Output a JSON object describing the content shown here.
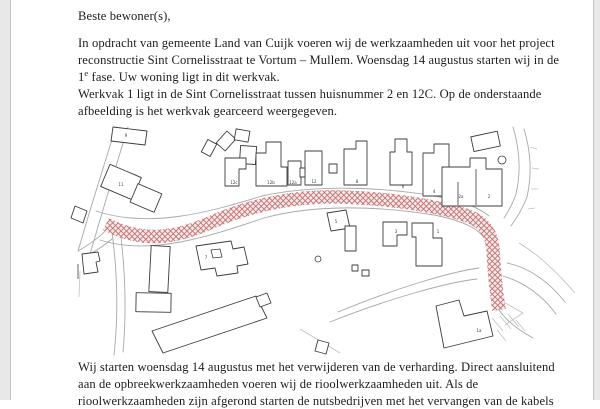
{
  "page": {
    "paper_color": "#ffffff",
    "margin_color": "#e8e8e8"
  },
  "letter": {
    "salutation": "Beste bewoner(s),",
    "paragraph_1": {
      "line_1": "In opdracht van gemeente Land van Cuijk voeren wij de werkzaamheden uit voor het project",
      "line_2": "reconstructie Sint Cornelisstraat te Vortum – Mullem. Woensdag 14 augustus starten wij in de",
      "line_3_num": "1",
      "line_3_sup": "e",
      "line_3_rest": " fase. Uw woning ligt in dit werkvak."
    },
    "paragraph_2": {
      "line_1": "Werkvak 1 ligt in de Sint Cornelisstraat tussen huisnummer 2 en 12C. Op de onderstaande",
      "line_2": "afbeelding is het werkvak gearceerd weergegeven."
    },
    "paragraph_3": {
      "line_1": "Wij starten woensdag 14 augustus met het verwijderen van de verharding. Direct aansluitend",
      "line_2": "aan de opbreekwerkzaamheden voeren wij de rioolwerkzaamheden uit. Als de",
      "line_3": "rioolwerkzaamheden zijn afgerond starten de nutsbedrijven met het vervangen van de kabels"
    }
  },
  "map": {
    "caption_meaning": "kadastrale kaart met gearceerd werkvak Sint Cornelisstraat",
    "hatch_line_color": "#c17272",
    "hatch_bg_color": "#f7e9e9",
    "building_line_color": "#3c3c3c",
    "road_line_color": "#a8a8a8",
    "house_numbers": [
      {
        "t": "9",
        "x": 126,
        "y": 137
      },
      {
        "t": "11",
        "x": 121,
        "y": 186
      },
      {
        "t": "12c",
        "x": 234,
        "y": 184
      },
      {
        "t": "12b",
        "x": 271,
        "y": 184
      },
      {
        "t": "12a",
        "x": 293,
        "y": 184
      },
      {
        "t": "12",
        "x": 314,
        "y": 183
      },
      {
        "t": "8",
        "x": 357,
        "y": 183
      },
      {
        "t": "6",
        "x": 403,
        "y": 188
      },
      {
        "t": "4",
        "x": 434,
        "y": 193
      },
      {
        "t": "2a",
        "x": 461,
        "y": 198
      },
      {
        "t": "2",
        "x": 489,
        "y": 198
      },
      {
        "t": "5",
        "x": 336,
        "y": 223
      },
      {
        "t": "3",
        "x": 396,
        "y": 233
      },
      {
        "t": "1",
        "x": 438,
        "y": 233
      },
      {
        "t": "7",
        "x": 206,
        "y": 259
      },
      {
        "t": "1a",
        "x": 479,
        "y": 332
      }
    ]
  }
}
